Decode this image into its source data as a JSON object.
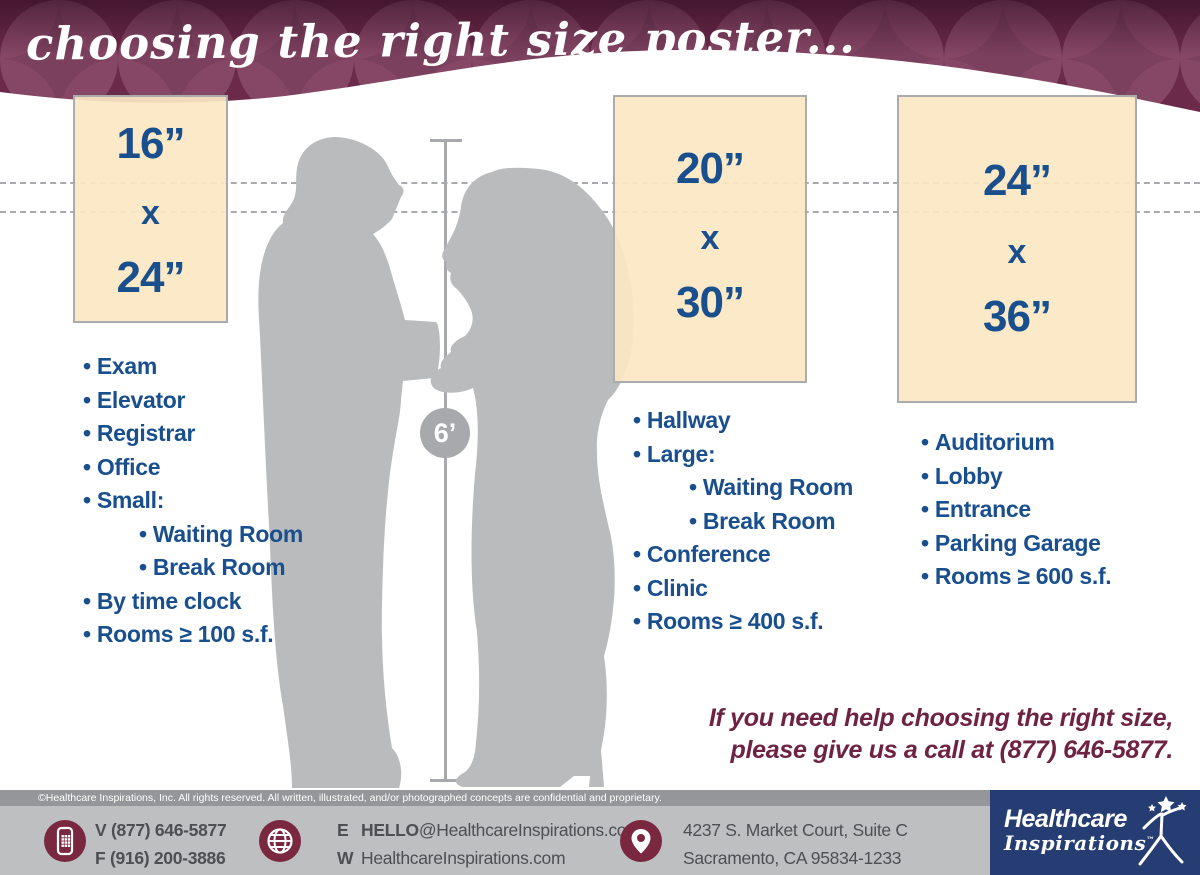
{
  "header": {
    "title": "choosing the right size poster..."
  },
  "measurement": {
    "height_label": "6’"
  },
  "bullet": "•",
  "posters": [
    {
      "size_top": "16”",
      "size_mid": "x",
      "size_bottom": "24”",
      "locations": [
        {
          "label": "Exam"
        },
        {
          "label": "Elevator"
        },
        {
          "label": "Registrar"
        },
        {
          "label": "Office"
        },
        {
          "label": "Small:"
        },
        {
          "label": "Waiting Room",
          "indent": true
        },
        {
          "label": "Break Room",
          "indent": true
        },
        {
          "label": "By time clock"
        },
        {
          "label": "Rooms ≥ 100 s.f."
        }
      ]
    },
    {
      "size_top": "20”",
      "size_mid": "x",
      "size_bottom": "30”",
      "locations": [
        {
          "label": "Hallway"
        },
        {
          "label": "Large:"
        },
        {
          "label": "Waiting Room",
          "indent": true
        },
        {
          "label": "Break Room",
          "indent": true
        },
        {
          "label": "Conference"
        },
        {
          "label": "Clinic"
        },
        {
          "label": "Rooms ≥ 400 s.f."
        }
      ]
    },
    {
      "size_top": "24”",
      "size_mid": "x",
      "size_bottom": "36”",
      "locations": [
        {
          "label": "Auditorium"
        },
        {
          "label": "Lobby"
        },
        {
          "label": "Entrance"
        },
        {
          "label": "Parking Garage"
        },
        {
          "label": "Rooms ≥ 600 s.f."
        }
      ]
    }
  ],
  "help": {
    "line1": "If you need help choosing the right size,",
    "line2": "please give us a call at (877) 646-5877."
  },
  "footer": {
    "copyright": "©Healthcare Inspirations, Inc.  All rights reserved. All written, illustrated, and/or photographed concepts are confidential and proprietary.",
    "phone": {
      "v_label": "V",
      "v_value": "(877) 646-5877",
      "f_label": "F",
      "f_value": "(916) 200-3886"
    },
    "online": {
      "e_label": "E",
      "email_user": "HELLO",
      "email_domain": "@HealthcareInspirations.com",
      "w_label": "W",
      "website": "HealthcareInspirations.com"
    },
    "address": {
      "line1": "4237 S. Market Court, Suite C",
      "line2": "Sacramento, CA 95834-1233"
    },
    "logo": {
      "word1": "Healthcare",
      "word2": "Inspirations",
      "tm": "™"
    }
  },
  "colors": {
    "navy": "#1a4f8e",
    "maroon": "#6f2342",
    "cream": "#fbe7c2",
    "silhouette": "#b9bbbd",
    "logo_navy": "#253d72",
    "icon_maroon": "#7a2840"
  }
}
